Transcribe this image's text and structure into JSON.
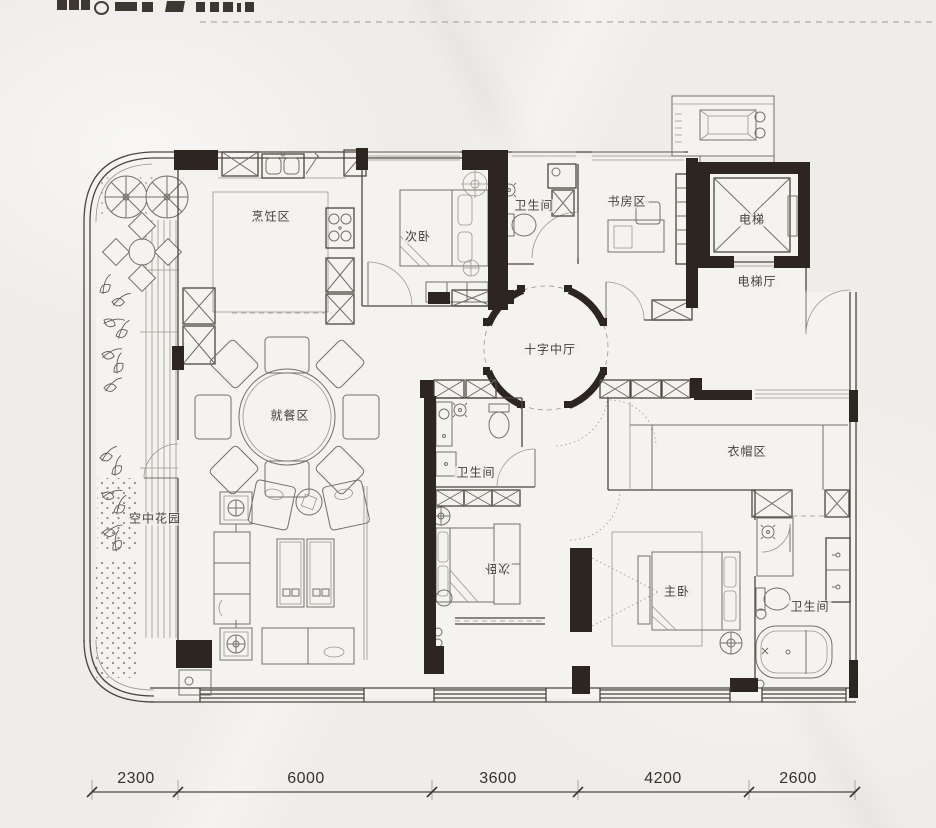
{
  "rooms": {
    "kitchen": "烹饪区",
    "bedroom_top": "次卧",
    "bath_top": "卫生间",
    "study": "书房区",
    "elevator": "电梯",
    "elevator_hall": "电梯厅",
    "central_hall": "十字中厅",
    "dining": "就餐区",
    "sky_garden": "空中花园",
    "bath_middle": "卫生间",
    "bedroom_bottom": "次卧",
    "cloakroom": "衣帽区",
    "master_bedroom": "主卧",
    "master_bath": "卫生间"
  },
  "dimensions": [
    "2300",
    "6000",
    "3600",
    "4200",
    "2600"
  ]
}
